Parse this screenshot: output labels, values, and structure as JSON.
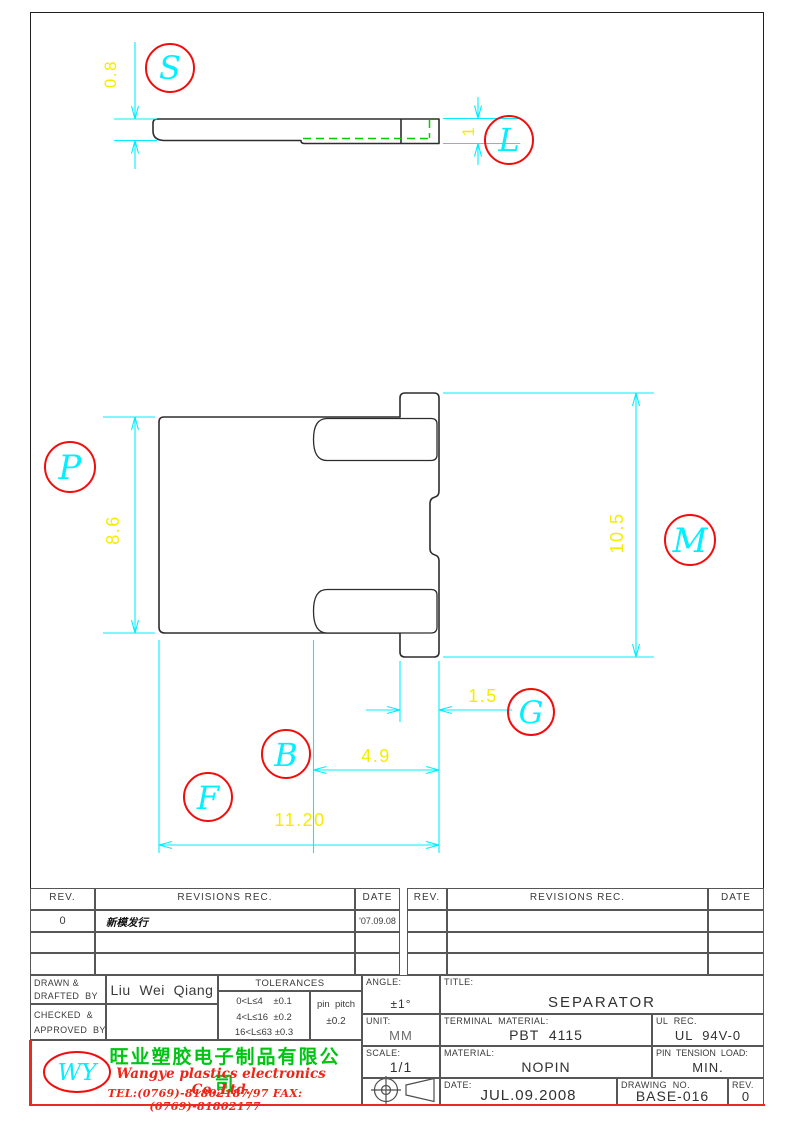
{
  "views": {
    "top": {
      "dims": {
        "thickness": "0.8",
        "end_thickness": "1"
      },
      "balloons": {
        "s": "S",
        "l": "L"
      }
    },
    "front": {
      "dims": {
        "body_height": "8.6",
        "overall_height": "10.5",
        "ear_width": "1.5",
        "slot_depth": "4.9",
        "overall_width": "11.20"
      },
      "balloons": {
        "p": "P",
        "m": "M",
        "g": "G",
        "b": "B",
        "f": "F"
      }
    }
  },
  "colors": {
    "dimension_lines": "#00eeff",
    "dimension_text": "#f6ec00",
    "balloon_circle": "#f20d0d",
    "balloon_letter": "#00f0ff",
    "hidden_line": "#00cc00",
    "company_cn": "#00c414",
    "company_en": "#f02419"
  },
  "revision_table": {
    "rev_header": "REV.",
    "revisions_header": "REVISIONS   REC.",
    "date_header": "DATE",
    "entry": {
      "rev": "0",
      "description": "新模发行",
      "date": "'07.09.08"
    }
  },
  "title_block": {
    "drawn_label": "DRAWN &\nDRAFTED  BY",
    "drawn_value": "Liu  Wei  Qiang",
    "checked_label": "CHECKED  &\nAPPROVED  BY",
    "tolerances": {
      "header": "TOLERANCES",
      "rows": "0<L≤4    ±0.1\n4<L≤16  ±0.2\n16<L≤63 ±0.3",
      "pin_pitch_label": "pin  pitch",
      "pin_pitch_value": "±0.2"
    },
    "angle_label": "ANGLE:",
    "angle_value": "±1°",
    "unit_label": "UNIT:",
    "unit_value": "MM",
    "scale_label": "SCALE:",
    "scale_value": "1/1",
    "title_label": "TITLE:",
    "title_value": "SEPARATOR",
    "terminal_material_label": "TERMINAL  MATERIAL:",
    "terminal_material_value": "PBT  4115",
    "ul_label": "UL  REC.",
    "ul_value": "UL  94V-0",
    "material_label": "MATERIAL:",
    "material_value": "NOPIN",
    "pin_tension_label": "PIN  TENSION  LOAD:",
    "pin_tension_value": "MIN.",
    "date_label": "DATE:",
    "date_value": "JUL.09.2008",
    "drawing_no_label": "DRAWING  NO.",
    "drawing_no_value": "BASE-016",
    "rev_label": "REV.",
    "rev_value": "0"
  },
  "company": {
    "logo": "WY",
    "name_cn": "旺业塑胶电子制品有限公司",
    "name_en": "Wangye plastics electronics Co.,Ltd.",
    "tel_fax": "TEL:(0769)-81802187/97   FAX:(0769)-81802177"
  }
}
